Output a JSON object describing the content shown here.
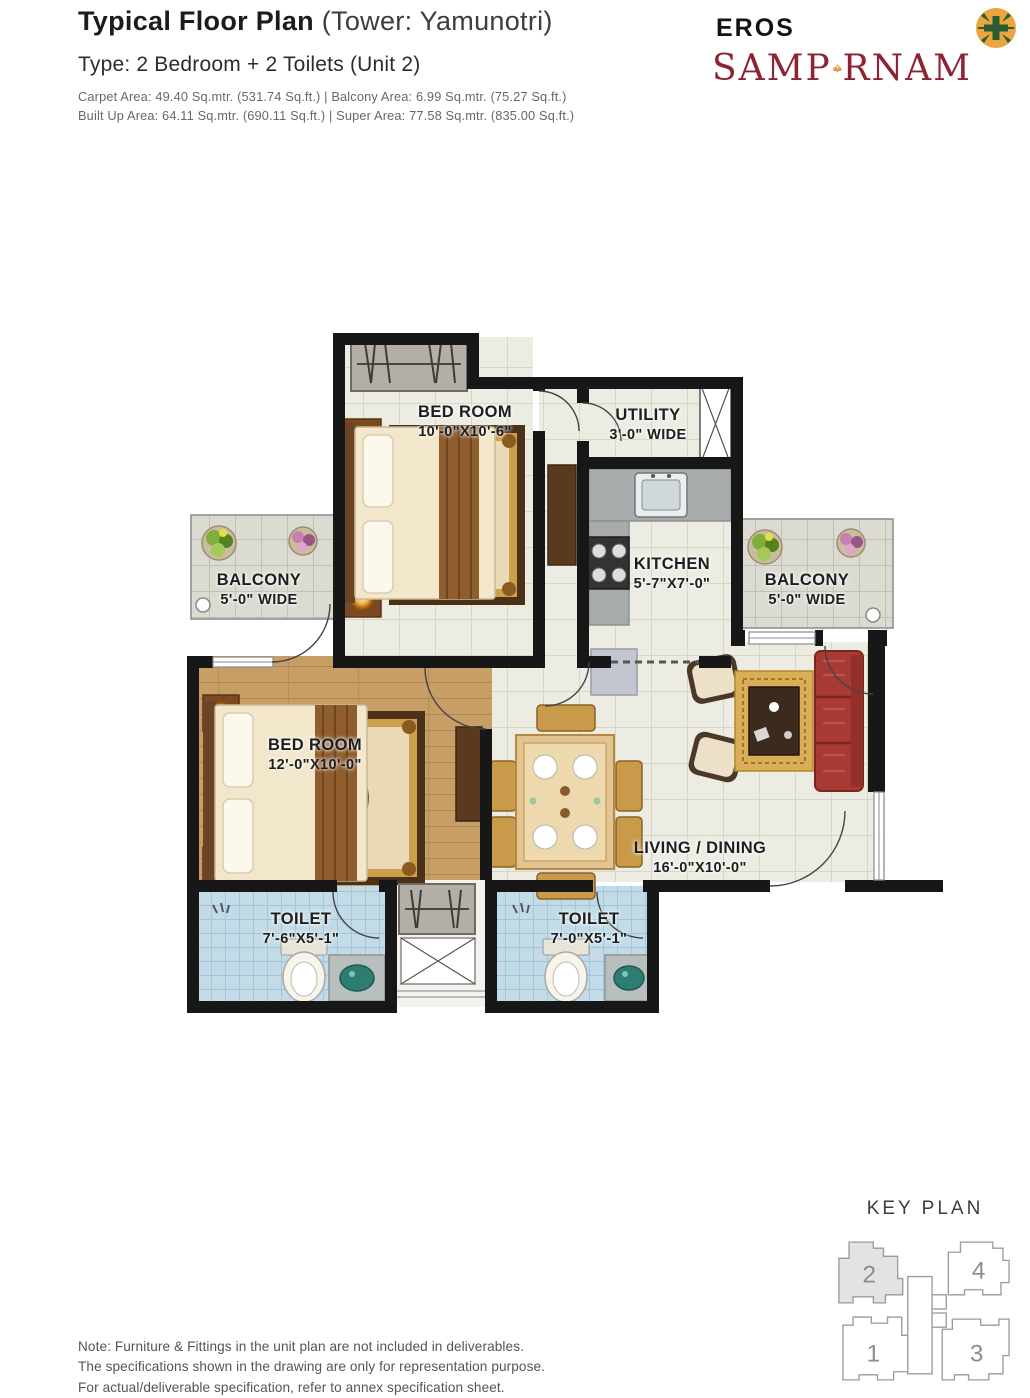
{
  "header": {
    "title_bold": "Typical Floor Plan",
    "title_rest": " (Tower: Yamunotri)",
    "subtitle": "Type: 2 Bedroom + 2 Toilets (Unit 2)",
    "area_line1": "Carpet Area: 49.40 Sq.mtr. (531.74 Sq.ft.)  |  Balcony Area: 6.99 Sq.mtr. (75.27 Sq.ft.)",
    "area_line2": "Built Up Area: 64.11 Sq.mtr. (690.11 Sq.ft.)  |  Super Area: 77.58 Sq.mtr. (835.00 Sq.ft.)"
  },
  "brand": {
    "name_top": "EROS",
    "name_left": "SAMP",
    "name_right": "RNAM",
    "colors": {
      "maroon": "#8e2433",
      "gold": "#e9a43b",
      "emblem_green": "#2a5d33"
    }
  },
  "floor_plan": {
    "rooms": [
      {
        "id": "bedroom-1",
        "name": "BED ROOM",
        "dims": "10'-0\"X10'-6\""
      },
      {
        "id": "utility",
        "name": "UTILITY",
        "dims": "3'-0\" WIDE"
      },
      {
        "id": "kitchen",
        "name": "KITCHEN",
        "dims": "5'-7\"X7'-0\""
      },
      {
        "id": "balcony-left",
        "name": "BALCONY",
        "dims": "5'-0\" WIDE"
      },
      {
        "id": "balcony-right",
        "name": "BALCONY",
        "dims": "5'-0\" WIDE"
      },
      {
        "id": "bedroom-2",
        "name": "BED ROOM",
        "dims": "12'-0\"X10'-0\""
      },
      {
        "id": "living-dining",
        "name": "LIVING / DINING",
        "dims": "16'-0\"X10'-0\""
      },
      {
        "id": "toilet-1",
        "name": "TOILET",
        "dims": "7'-6\"X5'-1\""
      },
      {
        "id": "toilet-2",
        "name": "TOILET",
        "dims": "7'-0\"X5'-1\""
      }
    ]
  },
  "key_plan": {
    "title": "KEY PLAN",
    "towers": [
      {
        "label": "2",
        "highlighted": true
      },
      {
        "label": "4",
        "highlighted": false
      },
      {
        "label": "1",
        "highlighted": false
      },
      {
        "label": "3",
        "highlighted": false
      }
    ],
    "highlight_color": "#e3e3e6"
  },
  "note_lines": [
    "Note: Furniture & Fittings in the unit plan are not included in deliverables.",
    "The specifications shown in the drawing are only for representation purpose.",
    "For actual/deliverable specification, refer to annex specification sheet."
  ]
}
